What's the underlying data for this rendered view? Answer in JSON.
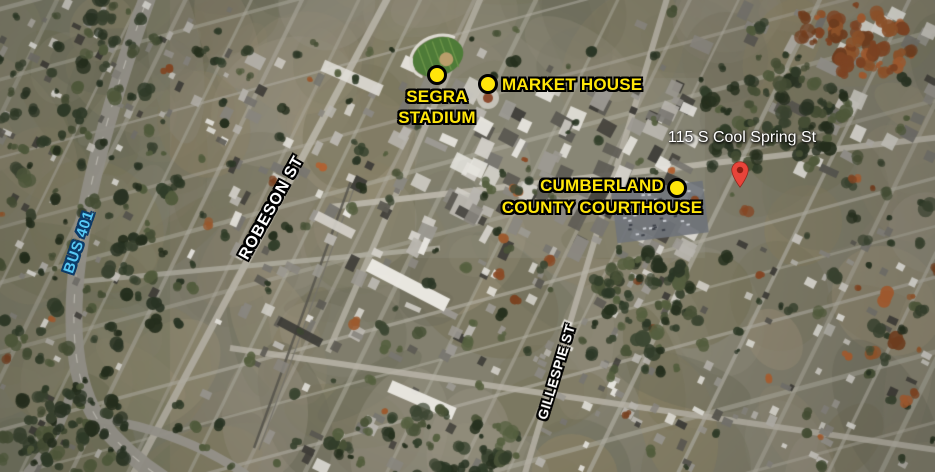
{
  "map": {
    "markers": [
      {
        "name": "segra-stadium",
        "lines": [
          "SEGRA",
          "STADIUM"
        ]
      },
      {
        "name": "market-house",
        "lines": [
          "MARKET HOUSE"
        ]
      },
      {
        "name": "cumberland-county-courthouse",
        "lines": [
          "CUMBERLAND",
          "COUNTY COURTHOUSE"
        ]
      }
    ],
    "address_pin": {
      "label": "115 S Cool Spring St"
    },
    "street_labels": [
      {
        "text": "ROBESON ST"
      },
      {
        "text": "GILLESPIE ST"
      },
      {
        "text": "BUS 401"
      }
    ],
    "colors": {
      "marker_yellow": "#ffe60a",
      "marker_outline": "#000000",
      "street_label_white": "#ffffff",
      "bus_route_blue": "#55c8f4",
      "bus_route_outline": "#0d3a66",
      "pin_red": "#e8443a"
    }
  }
}
